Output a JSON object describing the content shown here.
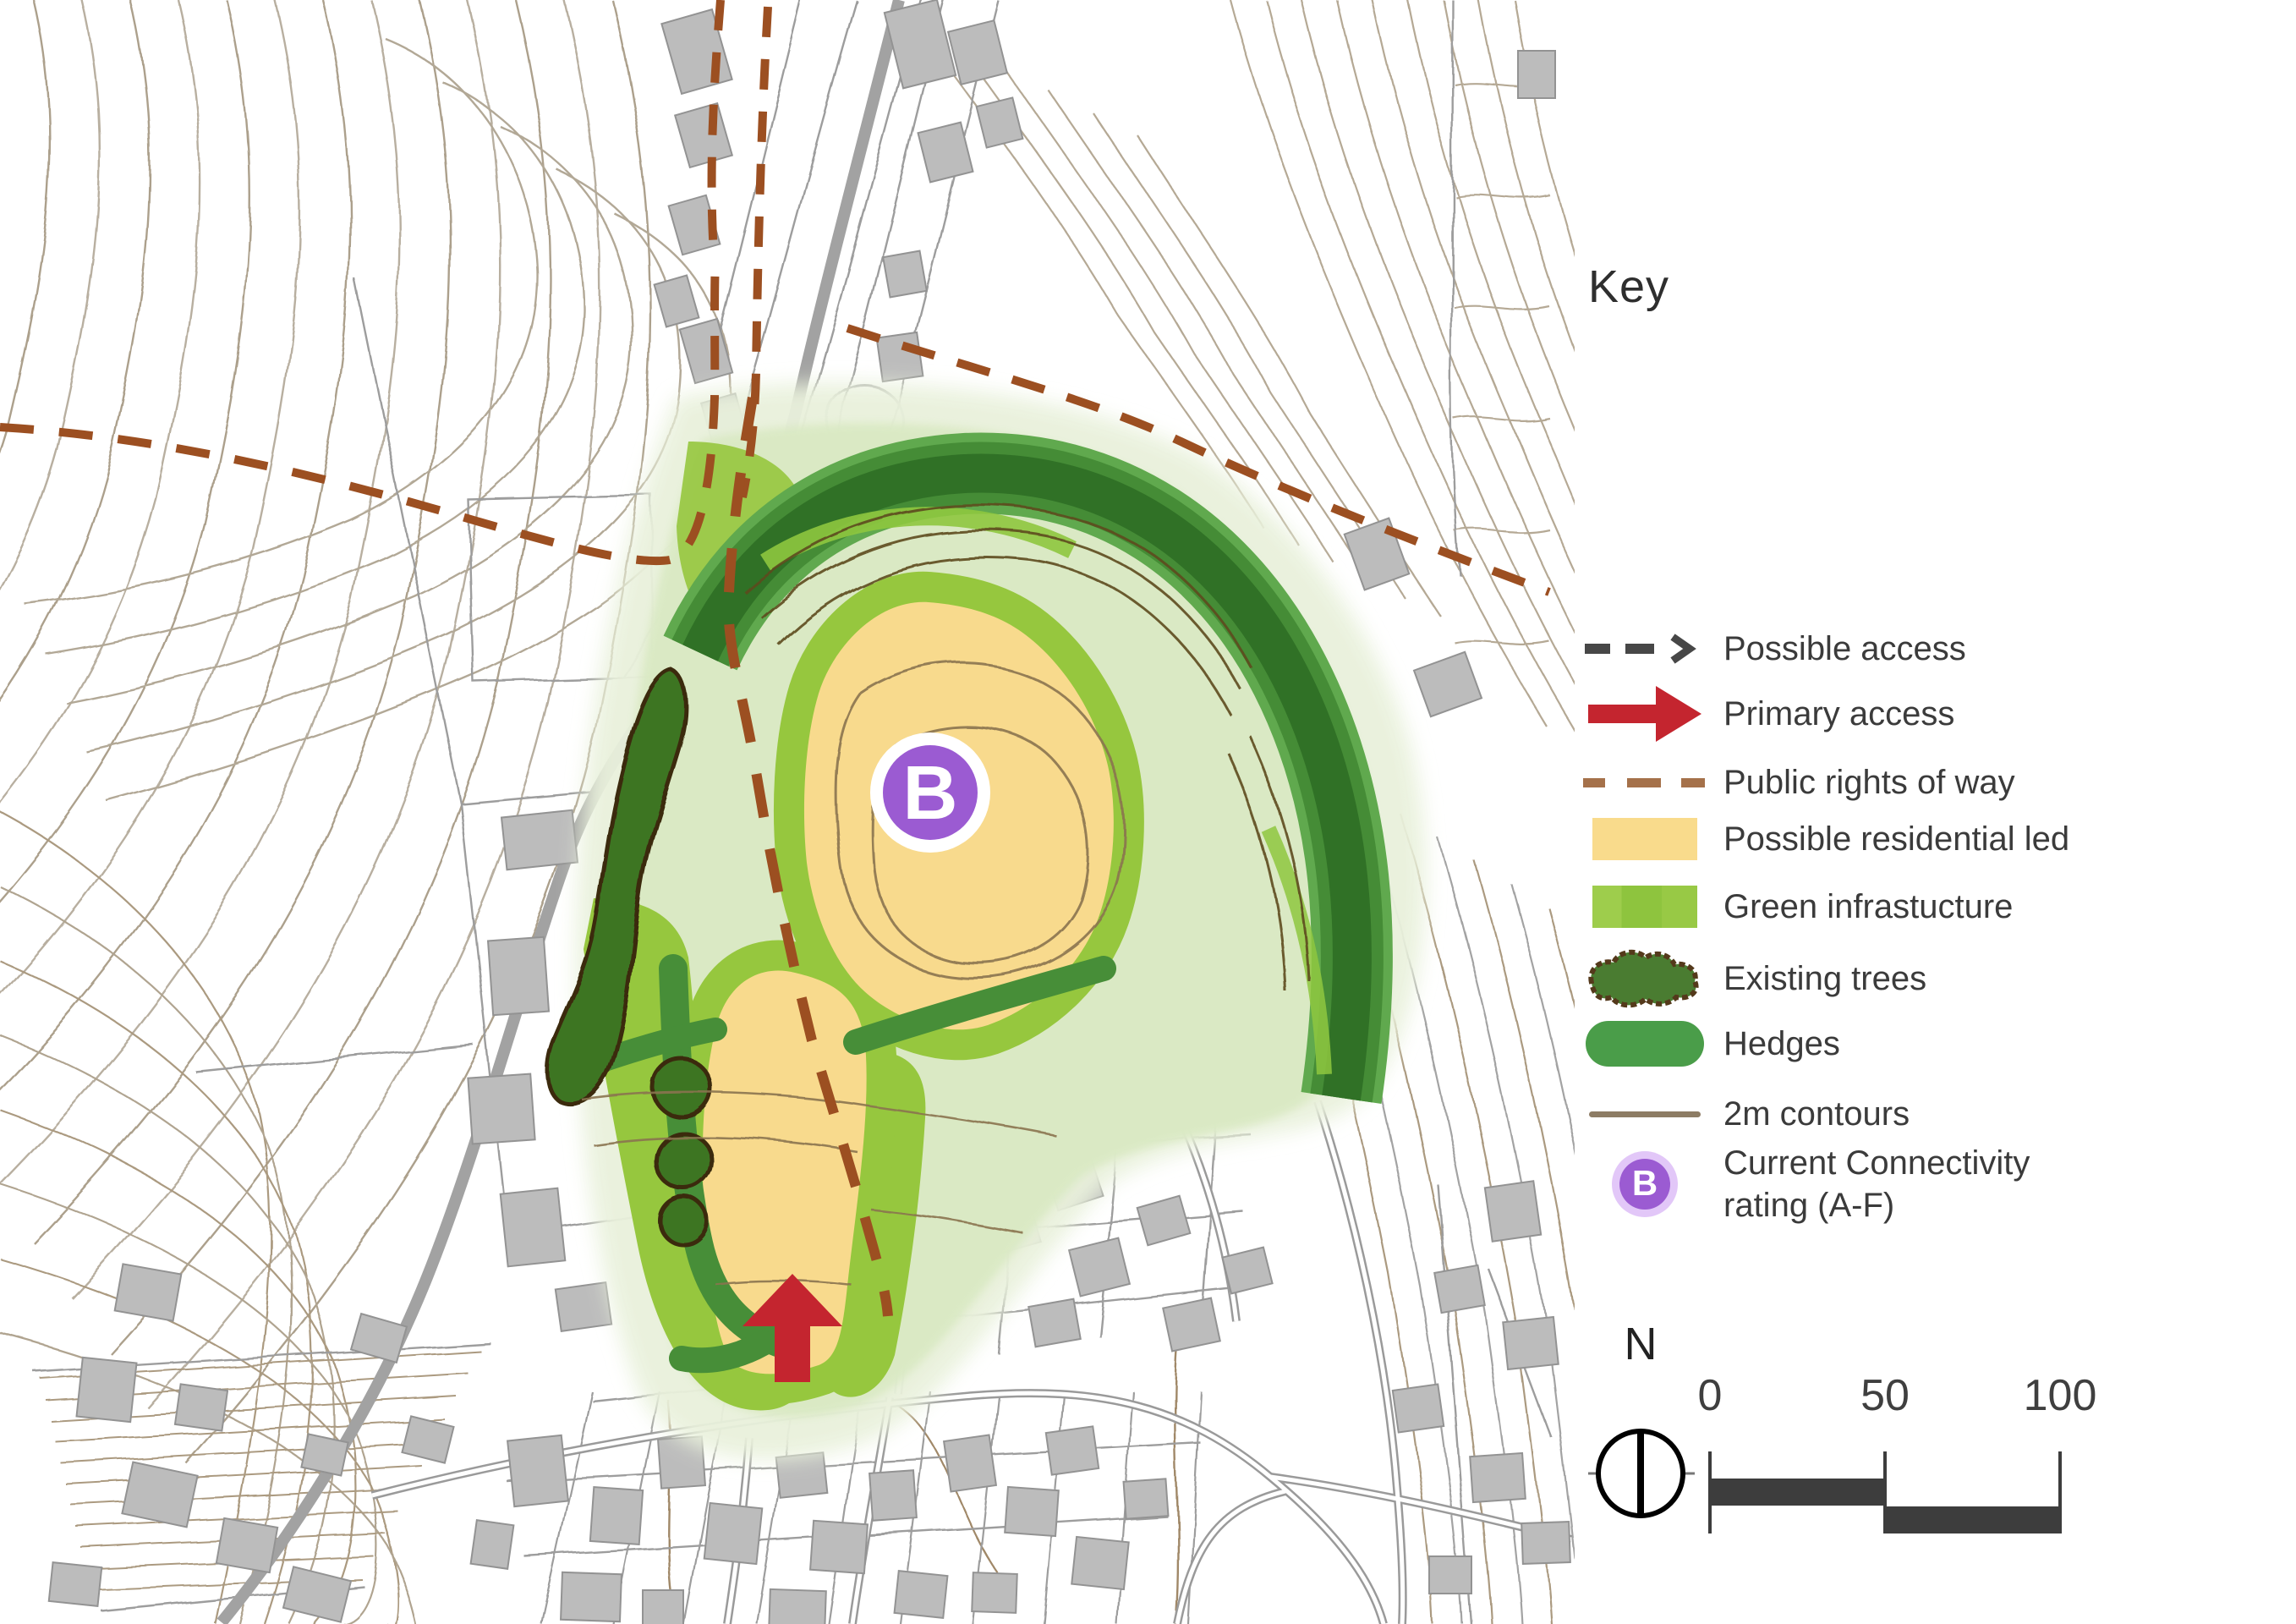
{
  "legend": {
    "title": "Key",
    "items": [
      {
        "id": "possible-access",
        "icon": "dashed-arrow-icon",
        "label": "Possible access"
      },
      {
        "id": "primary-access",
        "icon": "red-arrow-icon",
        "label": "Primary access"
      },
      {
        "id": "public-rights-of-way",
        "icon": "brown-dashes-icon",
        "label": "Public rights of way"
      },
      {
        "id": "possible-residential-led",
        "icon": "yellow-swatch",
        "label": "Possible residential led"
      },
      {
        "id": "green-infrastructure",
        "icon": "green-swatch",
        "label": "Green infrastucture"
      },
      {
        "id": "existing-trees",
        "icon": "tree-blob-icon",
        "label": "Existing trees"
      },
      {
        "id": "hedges",
        "icon": "hedge-pill-icon",
        "label": "Hedges"
      },
      {
        "id": "contours-2m",
        "icon": "contour-line-icon",
        "label": "2m contours"
      },
      {
        "id": "connectivity-rating",
        "icon": "rating-badge-icon",
        "label": "Current Connectivity rating (A-F)",
        "label_line1": "Current Connectivity",
        "label_line2": "rating (A-F)",
        "badge_letter": "B"
      }
    ]
  },
  "map": {
    "connectivity_badge_letter": "B"
  },
  "compass": {
    "north_label": "N"
  },
  "scale_bar": {
    "tick_labels": [
      "0",
      "50",
      "100"
    ]
  },
  "colors": {
    "residential_yellow": "#f8da8d",
    "green_infrastructure": "#96c73e",
    "hedge_green": "#458c36",
    "existing_trees_green": "#3e7524",
    "public_right_of_way_brown": "#9c4f21",
    "primary_access_red": "#c4252f",
    "connectivity_purple": "#9b5bd2",
    "contour_brown": "#ab9a80",
    "road_gray": "#a2a2a2"
  }
}
